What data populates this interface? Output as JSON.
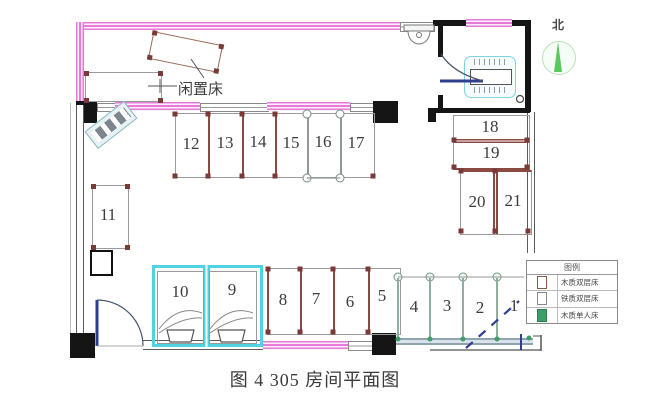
{
  "figure": {
    "caption": "图 4 305 房间平面图"
  },
  "annotations": {
    "idle_bed_label": "闲置床"
  },
  "north": {
    "label": "北"
  },
  "beds": {
    "top_row": [
      "12",
      "13",
      "14",
      "15",
      "16",
      "17"
    ],
    "right_column": [
      "18",
      "19",
      "20",
      "21"
    ],
    "left_single": "11",
    "cyan_pair": [
      "10",
      "9"
    ],
    "bottom_row": [
      "8",
      "7",
      "6",
      "5"
    ],
    "green_row": [
      "4",
      "3",
      "2",
      "1"
    ]
  },
  "legend": {
    "title": "图例",
    "items": [
      {
        "icon": "wood-bunk-bed-swatch",
        "label": "木质双层床"
      },
      {
        "icon": "iron-bunk-bed-swatch",
        "label": "铁质双层床"
      },
      {
        "icon": "wood-single-bed-swatch",
        "label": "木质单人床"
      }
    ]
  },
  "colors": {
    "wall_pink": "#e87ad9",
    "bed_brown": "#8a4a42",
    "post_dot": "#7a3b38",
    "highlight_cyan": "#4fd2e2",
    "single_bed_green": "#3f9e68",
    "door_blue": "#2f3e8f",
    "north_green": "#58c95a"
  }
}
